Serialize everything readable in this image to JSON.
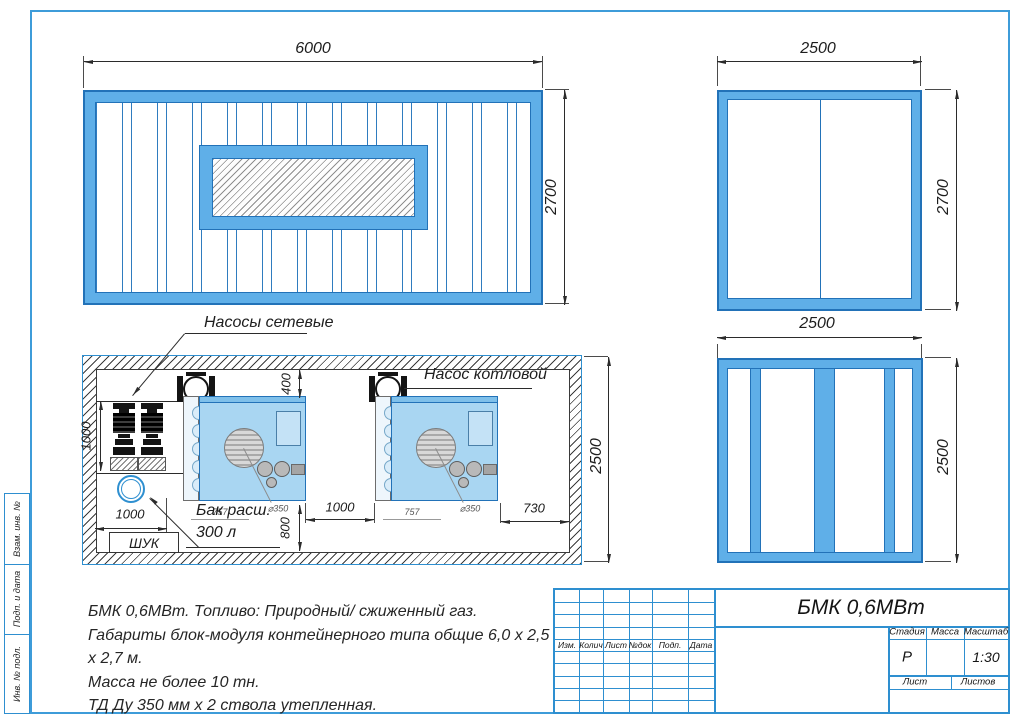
{
  "drawing": {
    "type": "container boiler plant drawing",
    "colors": {
      "frame_blue": "#3E9CD9",
      "container_fill": "#5FAFE8",
      "container_stroke": "#2272B8",
      "boiler_fill": "#A9D6F2"
    }
  },
  "views": {
    "front": {
      "width_dim": "6000",
      "height_dim": "2700"
    },
    "side_top": {
      "width_dim": "2500",
      "height_dim": "2700"
    },
    "side_bottom": {
      "width_dim": "2500",
      "height_dim": "2500"
    },
    "plan": {
      "height_dim": "2500",
      "pump_offset_dim": "1000",
      "boiler_top_gap_dim": "400",
      "boiler_bottom_gap_dim": "800",
      "tank_offset_dim": "1000",
      "between_boilers_dim": "1000",
      "right_gap_dim": "730",
      "boiler1_width_dim": "757",
      "boiler2_width_dim": "757",
      "flue1_dia_dim": "⌀350",
      "flue2_dia_dim": "⌀350",
      "labels": {
        "network_pumps": "Насосы сетевые",
        "boiler_pump": "Насос котловой",
        "tank_line1": "Бак расш.",
        "tank_line2": "300 л",
        "control_cabinet": "ШУК"
      }
    }
  },
  "notes": {
    "line1": "БМК 0,6МВт. Топливо: Природный/ сжиженный газ.",
    "line2": "Габариты блок-модуля контейнерного типа общие 6,0 х 2,5 х 2,7 м.",
    "line3": "Масса не более 10 тн.",
    "line4": "ТД Ду 350 мм х 2 ствола утепленная."
  },
  "title_block": {
    "title": "БМК 0,6МВт",
    "rev_headers": {
      "h1": "Изм.",
      "h2": "Колич",
      "h3": "Лист",
      "h4": "№док",
      "h5": "Подп.",
      "h6": "Дата"
    },
    "stage_label": "Стадия",
    "mass_label": "Масса",
    "scale_label": "Масштаб",
    "stage_value": "Р",
    "mass_value": "",
    "scale_value": "1:30",
    "sheet_label": "Лист",
    "sheets_label": "Листов"
  },
  "side_stamps": {
    "s1": "Взам. инв. №",
    "s2": "Подп. и дата",
    "s3": "Инв. № подл."
  }
}
